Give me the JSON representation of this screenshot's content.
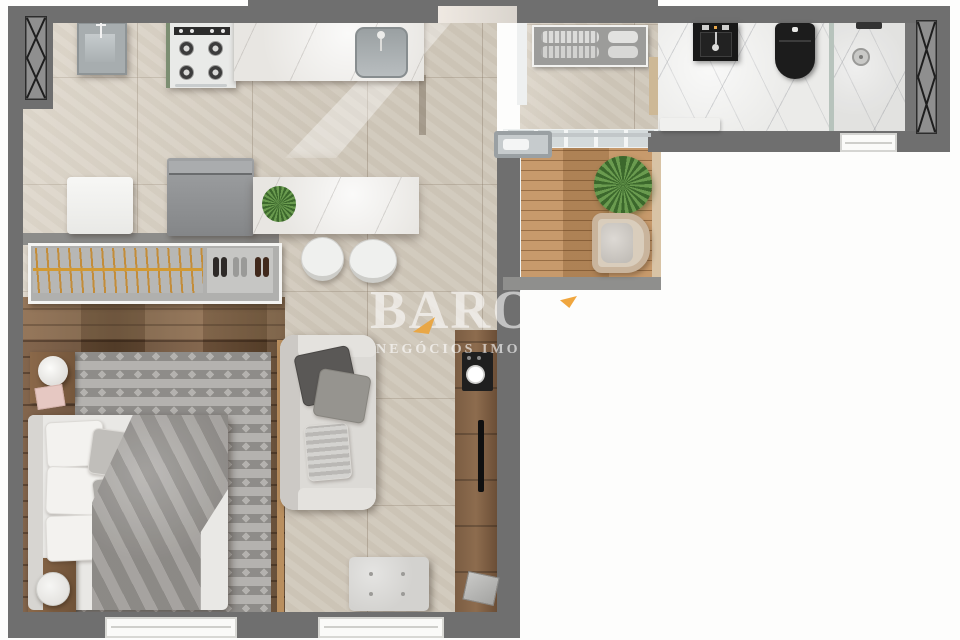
{
  "watermark": {
    "brand": "BARO",
    "tagline": "NEGÓCIOS IMOBILI"
  },
  "palette": {
    "wall_gray": "#6f6f6f",
    "travertine_floor": "#d9d1c3",
    "bedroom_wood": "#6b4e36",
    "deck_wood": "#c2915f",
    "bathroom_marble": "#ebebe9",
    "accent_orange": "#eda43c",
    "fixture_black": "#1c1c1c",
    "rug_light": "#b4b2af",
    "rug_dark": "#8e8c89",
    "sofa_gray": "#dcdad6"
  }
}
